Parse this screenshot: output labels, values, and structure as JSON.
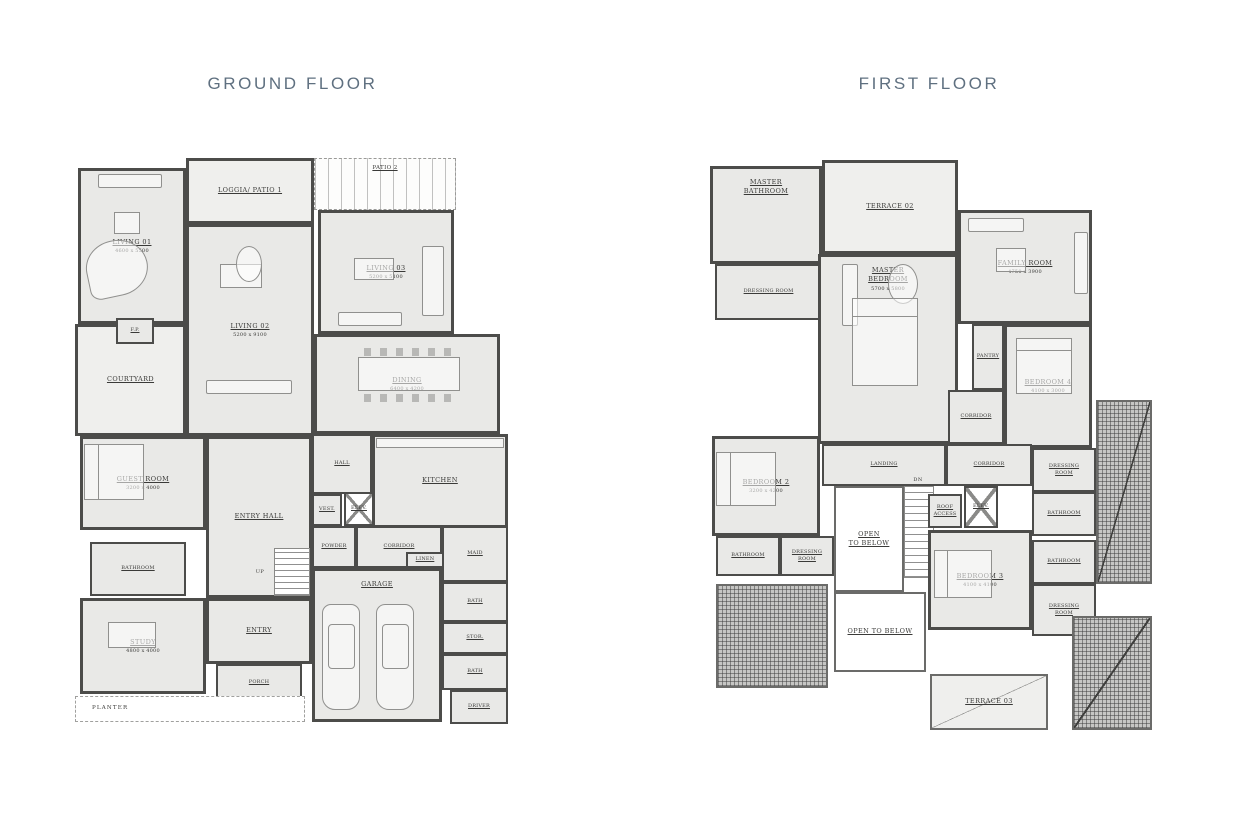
{
  "page": {
    "width": 1258,
    "height": 827,
    "background": "#ffffff"
  },
  "colors": {
    "title": "#5f7080",
    "wall": "#4c4c4a",
    "room_fill": "#e9e9e7",
    "outdoor_fill": "#efefed",
    "label": "#3a3a38"
  },
  "ground_floor": {
    "title": "GROUND FLOOR",
    "rooms": [
      {
        "id": "living-01",
        "label": "LIVING 01",
        "dims": "4600 x 5500",
        "x": 8,
        "y": 16,
        "w": 108,
        "h": 156,
        "kind": "room"
      },
      {
        "id": "loggia-patio-1",
        "label": "LOGGIA/ PATIO 1",
        "x": 116,
        "y": 6,
        "w": 128,
        "h": 66,
        "kind": "outdoor"
      },
      {
        "id": "patio-2",
        "label": "PATIO 2",
        "x": 244,
        "y": 6,
        "w": 142,
        "h": 52,
        "kind": "pergola"
      },
      {
        "id": "living-02",
        "label": "LIVING 02",
        "dims": "5200 x 9100",
        "x": 116,
        "y": 72,
        "w": 128,
        "h": 212,
        "kind": "room"
      },
      {
        "id": "living-03",
        "label": "LIVING 03",
        "dims": "5200 x 5100",
        "x": 248,
        "y": 58,
        "w": 136,
        "h": 124,
        "kind": "room"
      },
      {
        "id": "courtyard",
        "label": "COURTYARD",
        "x": 5,
        "y": 172,
        "w": 111,
        "h": 112,
        "kind": "outdoor"
      },
      {
        "id": "fireplace",
        "label": "F.P.",
        "x": 46,
        "y": 166,
        "w": 38,
        "h": 26,
        "kind": "room",
        "small": true
      },
      {
        "id": "dining",
        "label": "DINING",
        "dims": "6400 x 4200",
        "x": 244,
        "y": 182,
        "w": 186,
        "h": 100,
        "kind": "room"
      },
      {
        "id": "guest-room",
        "label": "GUEST ROOM",
        "dims": "3200 x 4000",
        "x": 10,
        "y": 284,
        "w": 126,
        "h": 94,
        "kind": "room"
      },
      {
        "id": "entry-hall",
        "label": "ENTRY HALL",
        "x": 136,
        "y": 284,
        "w": 106,
        "h": 162,
        "kind": "room"
      },
      {
        "id": "hall",
        "label": "HALL",
        "x": 242,
        "y": 282,
        "w": 60,
        "h": 60,
        "kind": "room",
        "small": true
      },
      {
        "id": "kitchen",
        "label": "KITCHEN",
        "x": 302,
        "y": 282,
        "w": 136,
        "h": 94,
        "kind": "room"
      },
      {
        "id": "vest",
        "label": "VEST.",
        "x": 242,
        "y": 342,
        "w": 30,
        "h": 32,
        "kind": "room",
        "small": true
      },
      {
        "id": "elev-ground",
        "label": "ELEV.",
        "x": 274,
        "y": 340,
        "w": 30,
        "h": 34,
        "kind": "elev",
        "small": true
      },
      {
        "id": "bathroom-ground",
        "label": "BATHROOM",
        "x": 20,
        "y": 390,
        "w": 96,
        "h": 54,
        "kind": "room",
        "small": true
      },
      {
        "id": "powder",
        "label": "POWDER",
        "x": 242,
        "y": 374,
        "w": 44,
        "h": 42,
        "kind": "room",
        "small": true
      },
      {
        "id": "corridor-ground",
        "label": "CORRIDOR",
        "x": 286,
        "y": 374,
        "w": 86,
        "h": 42,
        "kind": "room",
        "small": true
      },
      {
        "id": "linen",
        "label": "LINEN",
        "x": 336,
        "y": 400,
        "w": 38,
        "h": 16,
        "kind": "room",
        "small": true
      },
      {
        "id": "maid",
        "label": "MAID",
        "x": 372,
        "y": 374,
        "w": 66,
        "h": 56,
        "kind": "room",
        "small": true
      },
      {
        "id": "bath-1",
        "label": "BATH",
        "x": 372,
        "y": 430,
        "w": 66,
        "h": 40,
        "kind": "room",
        "small": true
      },
      {
        "id": "stor",
        "label": "STOR.",
        "x": 372,
        "y": 470,
        "w": 66,
        "h": 32,
        "kind": "room",
        "small": true
      },
      {
        "id": "bath-2",
        "label": "BATH",
        "x": 372,
        "y": 502,
        "w": 66,
        "h": 36,
        "kind": "room",
        "small": true
      },
      {
        "id": "garage",
        "label": "GARAGE",
        "x": 242,
        "y": 416,
        "w": 130,
        "h": 154,
        "kind": "room",
        "labelTop": true
      },
      {
        "id": "driver",
        "label": "DRIVER",
        "x": 380,
        "y": 538,
        "w": 58,
        "h": 34,
        "kind": "room",
        "small": true
      },
      {
        "id": "study",
        "label": "STUDY",
        "dims": "4800 x 4000",
        "x": 10,
        "y": 446,
        "w": 126,
        "h": 96,
        "kind": "room"
      },
      {
        "id": "entry",
        "label": "ENTRY",
        "x": 136,
        "y": 446,
        "w": 106,
        "h": 66,
        "kind": "room"
      },
      {
        "id": "porch",
        "label": "PORCH",
        "x": 146,
        "y": 512,
        "w": 86,
        "h": 38,
        "kind": "room",
        "small": true
      },
      {
        "id": "planter",
        "label": "PLANTER",
        "x": 5,
        "y": 544,
        "w": 230,
        "h": 26,
        "kind": "planter"
      },
      {
        "id": "up-label",
        "label": "UP",
        "x": 180,
        "y": 416,
        "w": 20,
        "h": 10,
        "kind": "label"
      }
    ],
    "furniture": [
      {
        "kind": "sofa",
        "x": 28,
        "y": 22,
        "w": 64,
        "h": 14
      },
      {
        "kind": "rect",
        "x": 44,
        "y": 60,
        "w": 26,
        "h": 22
      },
      {
        "kind": "piano",
        "x": 16,
        "y": 88,
        "w": 62,
        "h": 56
      },
      {
        "kind": "rect",
        "x": 150,
        "y": 112,
        "w": 42,
        "h": 24
      },
      {
        "kind": "oval",
        "x": 166,
        "y": 94,
        "w": 26,
        "h": 36
      },
      {
        "kind": "sofa",
        "x": 136,
        "y": 228,
        "w": 86,
        "h": 14
      },
      {
        "kind": "sofa",
        "x": 352,
        "y": 94,
        "w": 22,
        "h": 70
      },
      {
        "kind": "sofa",
        "x": 268,
        "y": 160,
        "w": 64,
        "h": 14
      },
      {
        "kind": "rect",
        "x": 284,
        "y": 106,
        "w": 40,
        "h": 22
      },
      {
        "kind": "chairs",
        "x": 294,
        "y": 196,
        "w": 90,
        "h": 8
      },
      {
        "kind": "rect",
        "x": 288,
        "y": 205,
        "w": 102,
        "h": 34
      },
      {
        "kind": "chairs",
        "x": 294,
        "y": 242,
        "w": 90,
        "h": 8
      },
      {
        "kind": "bed",
        "x": 14,
        "y": 292,
        "w": 60,
        "h": 56,
        "dir": "left"
      },
      {
        "kind": "rect",
        "x": 306,
        "y": 286,
        "w": 128,
        "h": 10
      },
      {
        "kind": "rect",
        "x": 38,
        "y": 470,
        "w": 48,
        "h": 26
      },
      {
        "kind": "stairs",
        "x": 204,
        "y": 396,
        "w": 36,
        "h": 48
      },
      {
        "kind": "car",
        "x": 252,
        "y": 452,
        "w": 38,
        "h": 106
      },
      {
        "kind": "car",
        "x": 306,
        "y": 452,
        "w": 38,
        "h": 106
      }
    ]
  },
  "first_floor": {
    "title": "FIRST FLOOR",
    "rooms": [
      {
        "id": "master-bathroom",
        "label": "MASTER\nBATHROOM",
        "x": 10,
        "y": 14,
        "w": 112,
        "h": 98,
        "kind": "room",
        "labelTop": true
      },
      {
        "id": "terrace-02",
        "label": "TERRACE 02",
        "x": 122,
        "y": 8,
        "w": 136,
        "h": 94,
        "kind": "outdoor"
      },
      {
        "id": "dressing-room-master",
        "label": "DRESSING ROOM",
        "x": 15,
        "y": 112,
        "w": 107,
        "h": 56,
        "kind": "room",
        "small": true
      },
      {
        "id": "master-bedroom",
        "label": "MASTER\nBEDROOM",
        "dims": "5700 x 5800",
        "x": 118,
        "y": 102,
        "w": 140,
        "h": 190,
        "kind": "room",
        "labelTop": true
      },
      {
        "id": "family-room",
        "label": "FAMILY ROOM",
        "dims": "4750 x 3900",
        "x": 258,
        "y": 58,
        "w": 134,
        "h": 114,
        "kind": "room"
      },
      {
        "id": "pantry",
        "label": "PANTRY",
        "x": 272,
        "y": 172,
        "w": 32,
        "h": 66,
        "kind": "room",
        "small": true
      },
      {
        "id": "corridor-upper",
        "label": "CORRIDOR",
        "x": 248,
        "y": 238,
        "w": 56,
        "h": 54,
        "kind": "room",
        "small": true
      },
      {
        "id": "bedroom-4",
        "label": "BEDROOM 4",
        "dims": "4100 x 3000",
        "x": 304,
        "y": 172,
        "w": 88,
        "h": 124,
        "kind": "room"
      },
      {
        "id": "landing",
        "label": "LANDING",
        "x": 122,
        "y": 292,
        "w": 124,
        "h": 42,
        "kind": "room",
        "small": true
      },
      {
        "id": "corridor-lower",
        "label": "CORRIDOR",
        "x": 246,
        "y": 292,
        "w": 86,
        "h": 42,
        "kind": "room",
        "small": true
      },
      {
        "id": "open-to-below-1",
        "label": "OPEN\nTO BELOW",
        "x": 134,
        "y": 334,
        "w": 70,
        "h": 106,
        "kind": "open"
      },
      {
        "id": "stairs-first",
        "x": 204,
        "y": 334,
        "w": 30,
        "h": 92,
        "kind": "stairs"
      },
      {
        "id": "dn-label",
        "label": "DN",
        "x": 206,
        "y": 324,
        "w": 24,
        "h": 9,
        "kind": "label"
      },
      {
        "id": "roof-access",
        "label": "ROOF\nACCESS",
        "x": 228,
        "y": 342,
        "w": 34,
        "h": 34,
        "kind": "room",
        "small": true
      },
      {
        "id": "elev-first",
        "label": "ELEV.",
        "x": 264,
        "y": 334,
        "w": 34,
        "h": 42,
        "kind": "elev",
        "small": true
      },
      {
        "id": "bedroom-3",
        "label": "BEDROOM 3",
        "dims": "4100 x 4100",
        "x": 228,
        "y": 378,
        "w": 104,
        "h": 100,
        "kind": "room"
      },
      {
        "id": "bedroom-2",
        "label": "BEDROOM 2",
        "dims": "3200 x 4200",
        "x": 12,
        "y": 284,
        "w": 108,
        "h": 100,
        "kind": "room"
      },
      {
        "id": "bathroom-bed2",
        "label": "BATHROOM",
        "x": 16,
        "y": 384,
        "w": 64,
        "h": 40,
        "kind": "room",
        "small": true
      },
      {
        "id": "dressing-room-bed2",
        "label": "DRESSING\nROOM",
        "x": 80,
        "y": 384,
        "w": 54,
        "h": 40,
        "kind": "room",
        "small": true
      },
      {
        "id": "dressing-room-bed4",
        "label": "DRESSING\nROOM",
        "x": 332,
        "y": 296,
        "w": 64,
        "h": 44,
        "kind": "room",
        "small": true
      },
      {
        "id": "bathroom-right-1",
        "label": "BATHROOM",
        "x": 332,
        "y": 340,
        "w": 64,
        "h": 44,
        "kind": "room",
        "small": true
      },
      {
        "id": "bathroom-right-2",
        "label": "BATHROOM",
        "x": 332,
        "y": 388,
        "w": 64,
        "h": 44,
        "kind": "room",
        "small": true
      },
      {
        "id": "dressing-room-bed3",
        "label": "DRESSING\nROOM",
        "x": 332,
        "y": 432,
        "w": 64,
        "h": 52,
        "kind": "room",
        "small": true
      },
      {
        "id": "open-to-below-2",
        "label": "OPEN TO BELOW",
        "x": 134,
        "y": 440,
        "w": 92,
        "h": 80,
        "kind": "open"
      },
      {
        "id": "terrace-03",
        "label": "TERRACE 03",
        "x": 230,
        "y": 522,
        "w": 118,
        "h": 56,
        "kind": "terrace-diag"
      },
      {
        "id": "roof-left",
        "x": 16,
        "y": 432,
        "w": 112,
        "h": 104,
        "kind": "hatch"
      },
      {
        "id": "roof-right",
        "x": 396,
        "y": 248,
        "w": 56,
        "h": 184,
        "kind": "hatch",
        "diag": true
      },
      {
        "id": "roof-bottom-right",
        "x": 372,
        "y": 464,
        "w": 80,
        "h": 114,
        "kind": "hatch",
        "diag": true
      }
    ],
    "furniture": [
      {
        "kind": "sofa",
        "x": 142,
        "y": 112,
        "w": 16,
        "h": 62
      },
      {
        "kind": "oval",
        "x": 188,
        "y": 112,
        "w": 30,
        "h": 40
      },
      {
        "kind": "bed",
        "x": 152,
        "y": 146,
        "w": 66,
        "h": 88,
        "dir": "top"
      },
      {
        "kind": "sofa",
        "x": 268,
        "y": 66,
        "w": 56,
        "h": 14
      },
      {
        "kind": "sofa",
        "x": 374,
        "y": 80,
        "w": 14,
        "h": 62
      },
      {
        "kind": "rect",
        "x": 296,
        "y": 96,
        "w": 30,
        "h": 24
      },
      {
        "kind": "bed",
        "x": 316,
        "y": 186,
        "w": 56,
        "h": 56,
        "dir": "top"
      },
      {
        "kind": "bed",
        "x": 16,
        "y": 300,
        "w": 60,
        "h": 54,
        "dir": "left"
      },
      {
        "kind": "bed",
        "x": 234,
        "y": 398,
        "w": 58,
        "h": 48,
        "dir": "left"
      }
    ]
  }
}
